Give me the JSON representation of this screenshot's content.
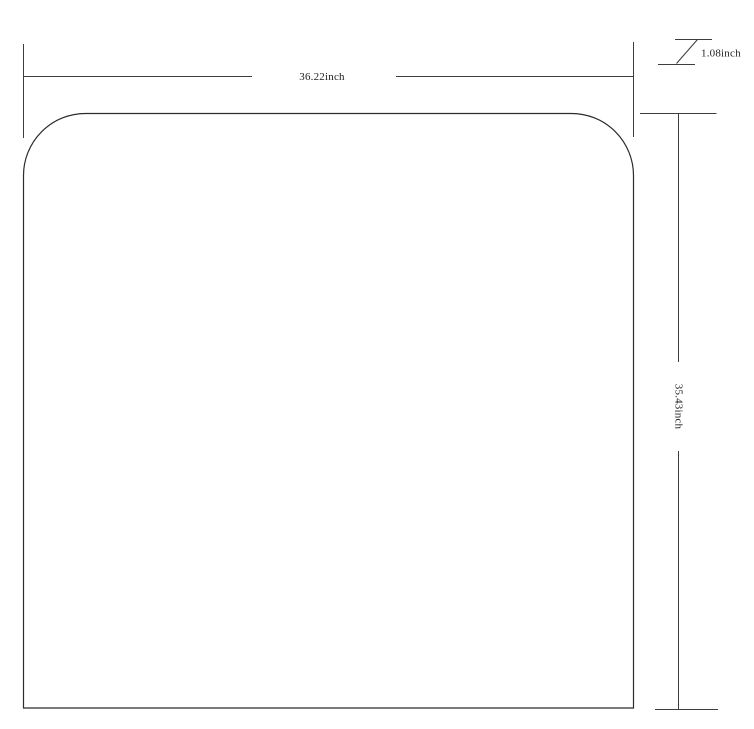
{
  "drawing": {
    "kind": "dimensioned-outline-diagram",
    "shape": {
      "description": "rectangle with rounded top corners and square bottom corners"
    },
    "dimensions": {
      "width": {
        "label": "36.22inch",
        "value": 36.22,
        "unit": "inch"
      },
      "height": {
        "label": "35.43inch",
        "value": 35.43,
        "unit": "inch"
      },
      "small": {
        "label": "1.08inch",
        "value": 1.08,
        "unit": "inch"
      }
    },
    "colors": {
      "background": "#ffffff",
      "outline": "#2c2c2c",
      "dimension_lines": "#3d3d3d",
      "text": "#1e1e1e"
    }
  }
}
